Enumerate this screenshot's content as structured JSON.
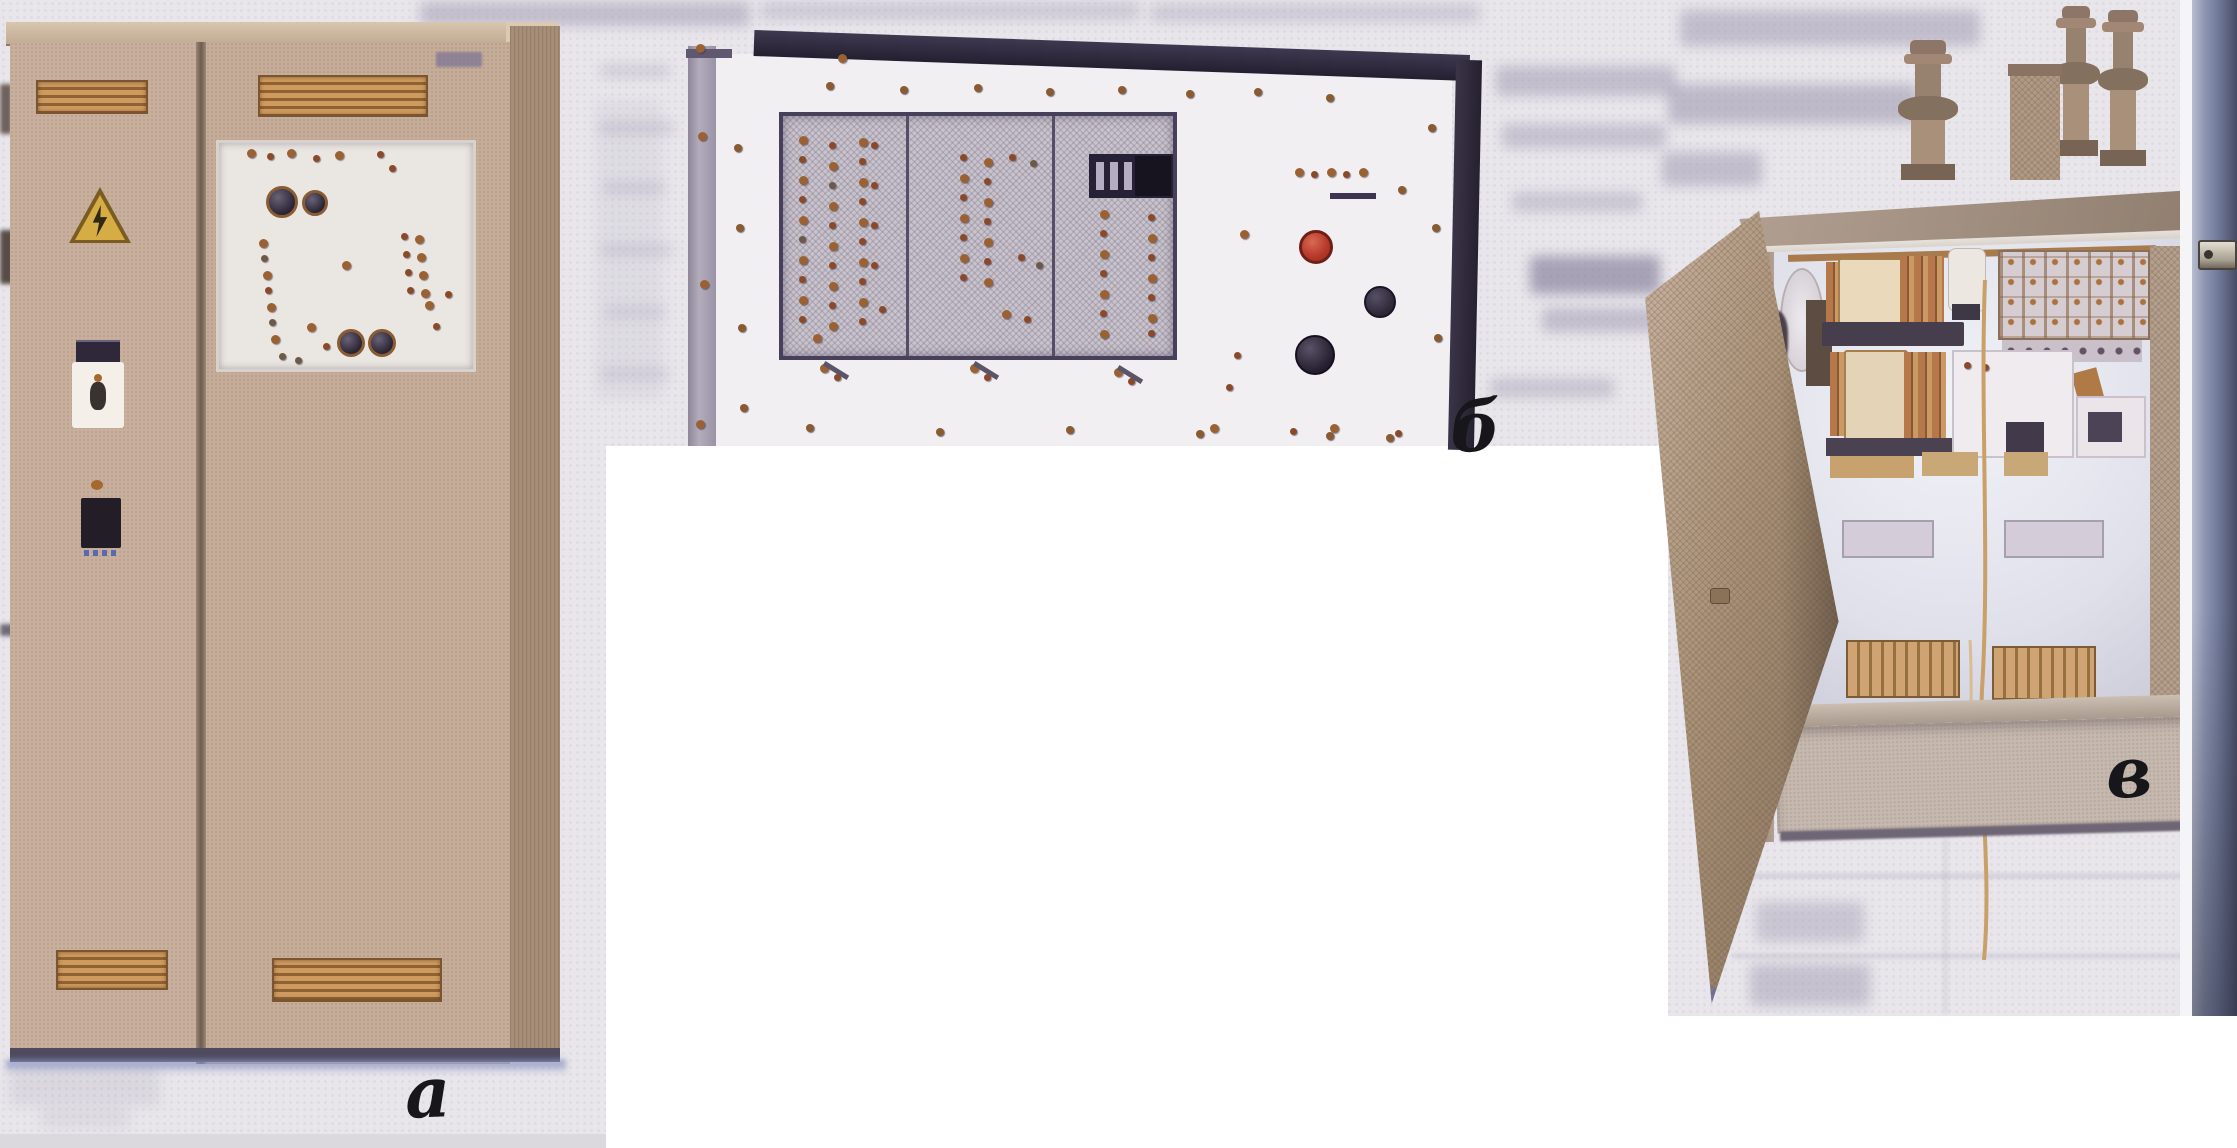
{
  "figure": {
    "type": "scanned-book-photo-plate",
    "panels": [
      {
        "id": "floor-cabinet",
        "label": "а"
      },
      {
        "id": "rack-panel",
        "label": "б"
      },
      {
        "id": "wall-mounted-box",
        "label": "в"
      }
    ]
  },
  "colors": {
    "page_background": "#e8e6eb",
    "cutout_white": "#ffffff",
    "cabinet_beige": "#c6ad9a",
    "vent_grille_orange": "#c08a52",
    "warning_triangle_amber": "#d6ac44",
    "panel_face_white": "#f1eff2",
    "panel_frame_dark": "#2c2838",
    "stop_button_red": "#b83a2c",
    "indicator_amber": "#9a6233",
    "box_metal_tan": "#b2a092",
    "interior_light": "#eef0f6",
    "copper_winding": "#b5784a",
    "page_edge_blue": "#747d9c"
  }
}
